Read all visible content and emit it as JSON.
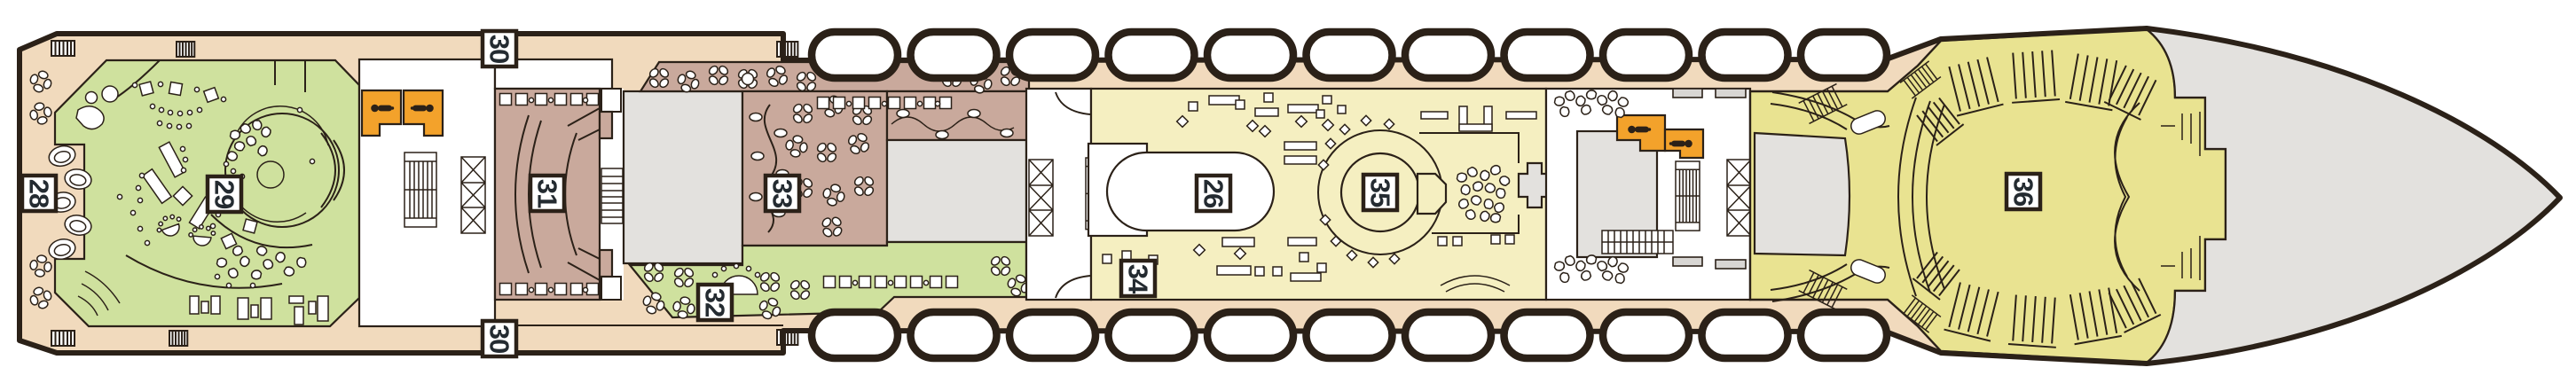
{
  "deck_plan": {
    "labels": {
      "n28": "28",
      "n29": "29",
      "n30_top": "30",
      "n31": "31",
      "n32": "32",
      "n33": "33",
      "n30_bottom": "30",
      "n34": "34",
      "n26": "26",
      "n35": "35",
      "n36": "36"
    },
    "icons": {
      "elevator": "elevator-person-icon",
      "stairs": "stairs-hatch-icon",
      "escalator": "crossed-escalator-icon",
      "lifeboat": "lifeboat-icon",
      "gangway": "gangway-hatch-icon",
      "table": "table-and-chairs-icon"
    },
    "colors": {
      "outline": "#2b2118",
      "deck_beige": "#f1dabd",
      "lounge_green": "#cfe19e",
      "venue_brown": "#c9a99c",
      "pale_yellow": "#f5efc1",
      "theatre_yellow": "#e9e391",
      "service_grey": "#e3e1de",
      "light_grey": "#d8d6d3",
      "elevator_orange": "#f3a22b",
      "label_text": "#242b31"
    }
  }
}
